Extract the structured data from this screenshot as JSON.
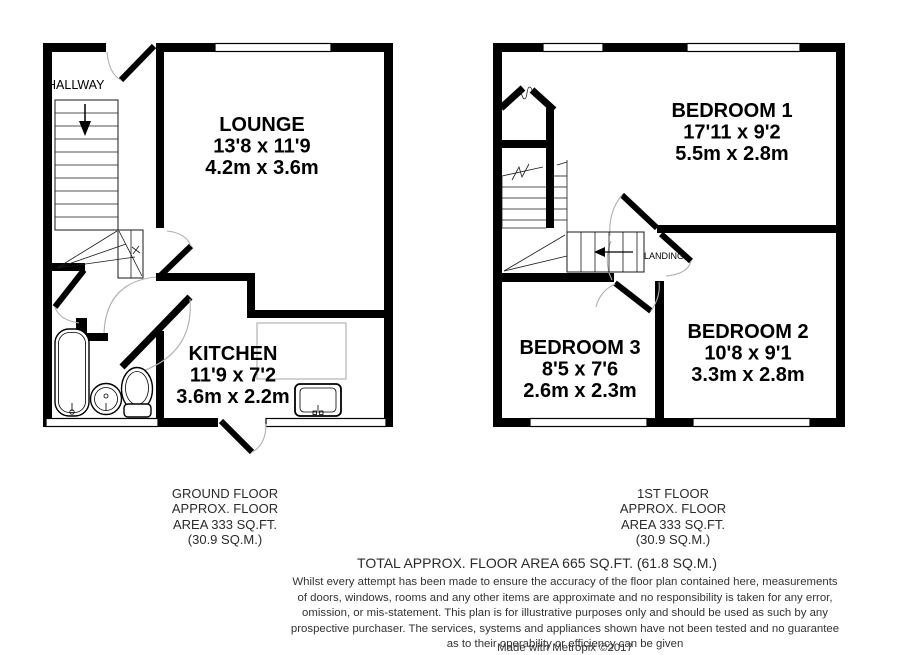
{
  "document_type": "floor-plan",
  "plans": {
    "ground": {
      "rooms": {
        "hallway": {
          "name": "HALLWAY"
        },
        "lounge": {
          "name": "LOUNGE",
          "size_imperial": "13'8 x 11'9",
          "size_metric": "4.2m x 3.6m"
        },
        "kitchen": {
          "name": "KITCHEN",
          "size_imperial": "11'9 x 7'2",
          "size_metric": "3.6m x 2.2m"
        }
      }
    },
    "first": {
      "rooms": {
        "landing": {
          "name": "LANDING"
        },
        "bedroom1": {
          "name": "BEDROOM 1",
          "size_imperial": "17'11 x 9'2",
          "size_metric": "5.5m x 2.8m"
        },
        "bedroom2": {
          "name": "BEDROOM 2",
          "size_imperial": "10'8 x 9'1",
          "size_metric": "3.3m x 2.8m"
        },
        "bedroom3": {
          "name": "BEDROOM 3",
          "size_imperial": "8'5 x 7'6",
          "size_metric": "2.6m x 2.3m"
        }
      }
    }
  },
  "captions": {
    "ground": {
      "lines": [
        "GROUND FLOOR",
        "APPROX. FLOOR",
        "AREA 333 SQ.FT.",
        "(30.9 SQ.M.)"
      ]
    },
    "first": {
      "lines": [
        "1ST FLOOR",
        "APPROX. FLOOR",
        "AREA 333 SQ.FT.",
        "(30.9 SQ.M.)"
      ]
    }
  },
  "footer": {
    "total": "TOTAL APPROX. FLOOR AREA 665 SQ.FT. (61.8 SQ.M.)",
    "disclaimer_lines": [
      "Whilst every attempt has been made to ensure the accuracy of the floor plan contained here, measurements",
      "of doors, windows, rooms and any other items are approximate and no responsibility is taken for any error,",
      "omission, or mis-statement. This plan is for illustrative purposes only and should be used as such by any",
      "prospective purchaser. The services, systems and appliances shown have not been tested and no guarantee",
      "as to their operability or efficiency can be given"
    ],
    "credit": "Made with Metropix ©2017"
  },
  "colors": {
    "background": "#ffffff",
    "wall": "#000000",
    "door_arc": "#b0b0b0",
    "counter": "#b4b4b4",
    "text": "#1a1a1a"
  }
}
